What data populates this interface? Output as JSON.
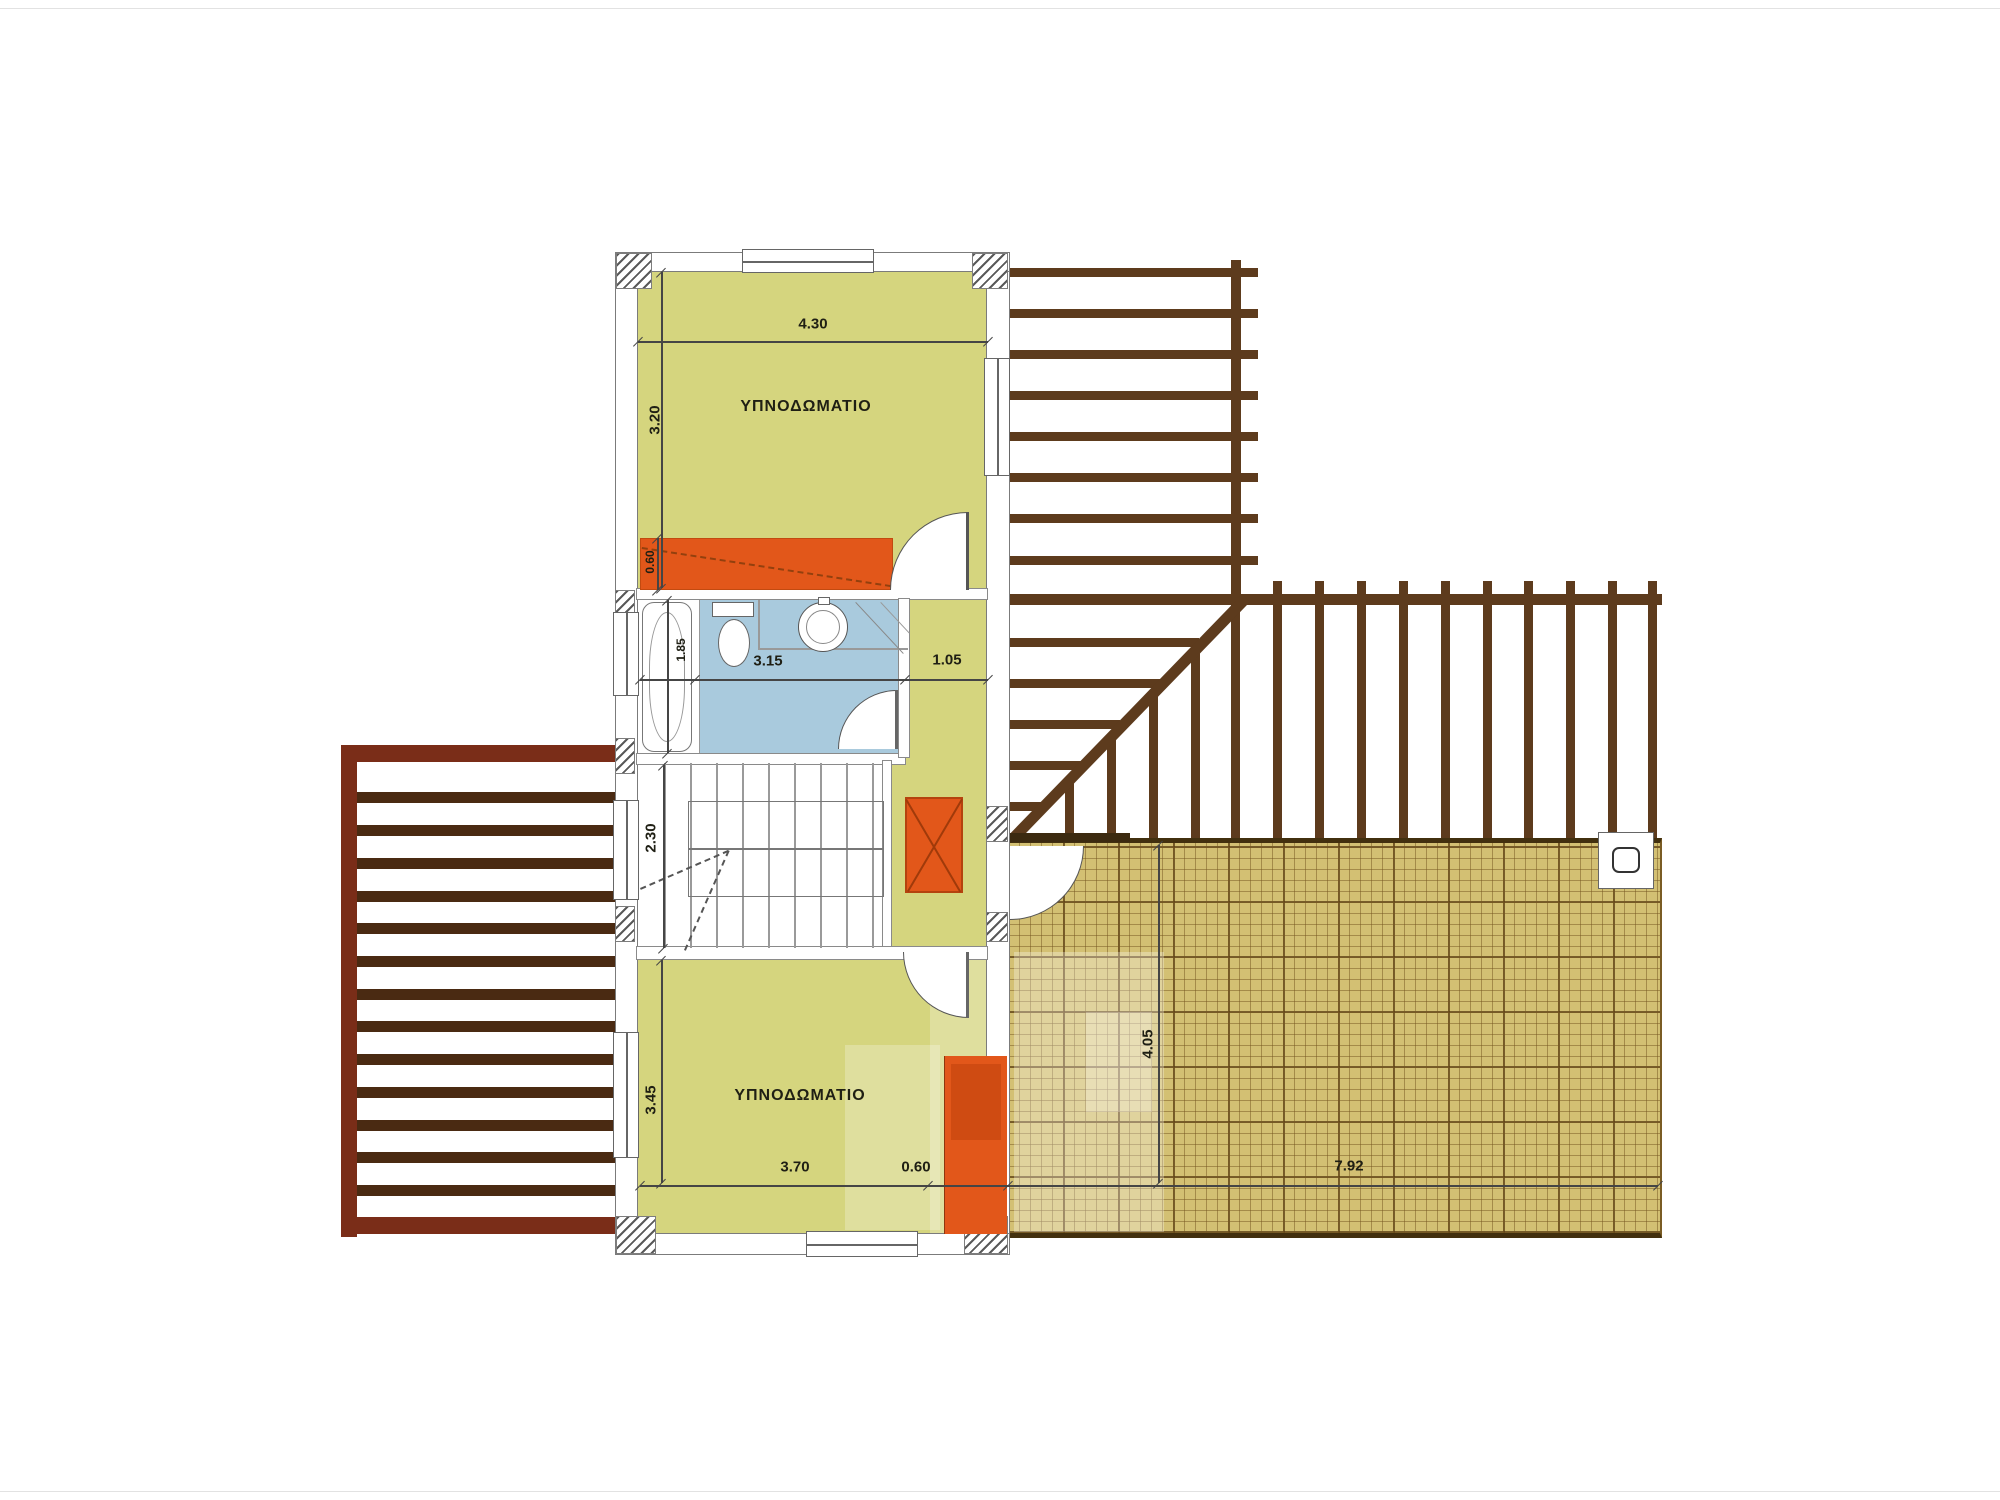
{
  "plan": {
    "rooms": {
      "bedroom_top": {
        "label": "ΥΠΝΟΔΩΜΑΤΙΟ"
      },
      "bedroom_bottom": {
        "label": "ΥΠΝΟΔΩΜΑΤΙΟ"
      }
    },
    "dimensions": {
      "bedroom_top_width": "4.30",
      "bedroom_top_depth": "3.20",
      "wardrobe_top_depth": "0.60",
      "bath_depth": "1.85",
      "bath_width": "3.15",
      "hall_width": "1.05",
      "stair_depth": "2.30",
      "bedroom_bottom_depth": "3.45",
      "bedroom_bottom_width": "3.70",
      "wardrobe_bottom_width": "0.60",
      "terrace_depth": "4.05",
      "terrace_width": "7.92"
    },
    "colors": {
      "room_fill": "#d5d57e",
      "room_fill_light": "#dede96",
      "bath_fill": "#a9cadd",
      "accent_orange": "#e2571a",
      "terrace_fill": "#d3c073",
      "pergola_brown": "#5d3b1d",
      "pergola_frame": "#7a2d18",
      "wall_line": "#7b7b7b"
    }
  }
}
